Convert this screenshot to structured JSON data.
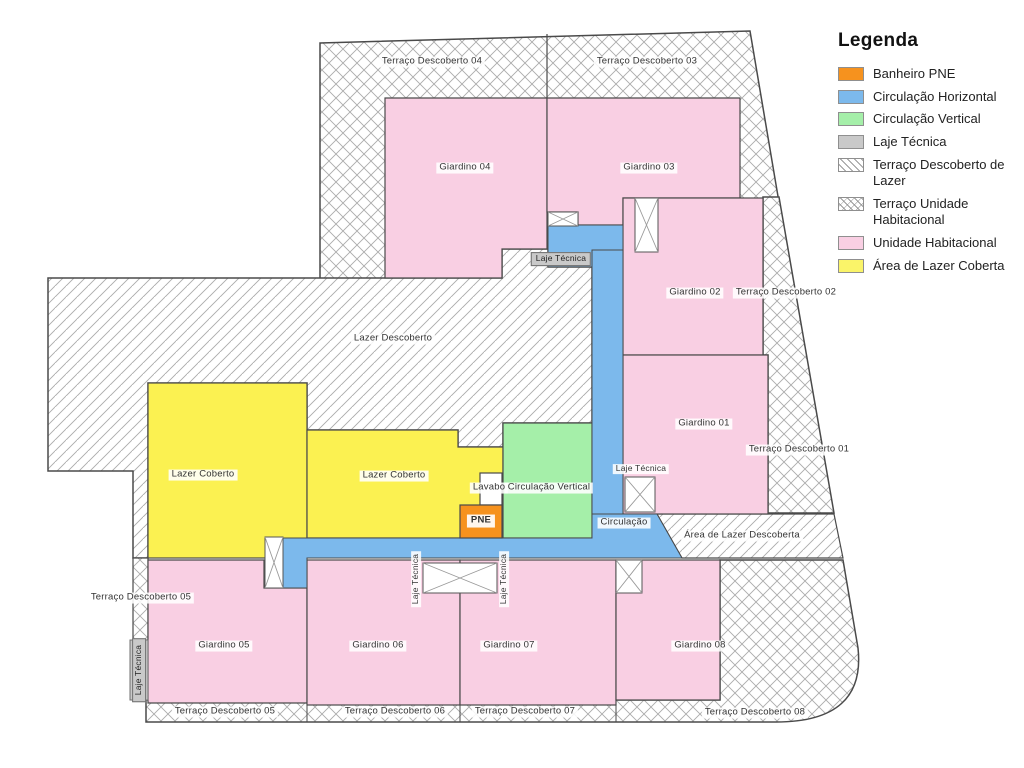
{
  "legend": {
    "title": "Legenda",
    "items": [
      {
        "label": "Banheiro PNE",
        "color": "#F6921E",
        "pattern": "solid"
      },
      {
        "label": "Circulação Horizontal",
        "color": "#7CB9EC",
        "pattern": "solid"
      },
      {
        "label": "Circulação Vertical",
        "color": "#A5EFA9",
        "pattern": "solid"
      },
      {
        "label": "Laje Técnica",
        "color": "#C9C9C9",
        "pattern": "solid"
      },
      {
        "label": "Terraço Descoberto de Lazer",
        "color": "#FFFFFF",
        "pattern": "diagonal"
      },
      {
        "label": "Terraço Unidade Habitacional",
        "color": "#FFFFFF",
        "pattern": "cross"
      },
      {
        "label": "Unidade Habitacional",
        "color": "#F9CFE3",
        "pattern": "solid"
      },
      {
        "label": "Área de Lazer Coberta",
        "color": "#FAF469",
        "pattern": "solid"
      }
    ]
  },
  "plan": {
    "labels": {
      "terraco_descoberto_01": "Terraço Descoberto 01",
      "terraco_descoberto_02": "Terraço Descoberto 02",
      "terraco_descoberto_03": "Terraço Descoberto 03",
      "terraco_descoberto_04": "Terraço Descoberto 04",
      "terraco_descoberto_05": "Terraço Descoberto 05",
      "terraco_descoberto_06": "Terraço Descoberto 06",
      "terraco_descoberto_07": "Terraço Descoberto 07",
      "terraco_descoberto_08": "Terraço Descoberto 08",
      "giardino_01": "Giardino 01",
      "giardino_02": "Giardino 02",
      "giardino_03": "Giardino 03",
      "giardino_04": "Giardino 04",
      "giardino_05": "Giardino 05",
      "giardino_06": "Giardino 06",
      "giardino_07": "Giardino 07",
      "giardino_08": "Giardino 08",
      "lazer_descoberto": "Lazer Descoberto",
      "lazer_coberto": "Lazer Coberto",
      "area_de_lazer_descoberta": "Área de Lazer Descoberta",
      "circulacao": "Circulação",
      "circulacao_vertical": "Circulação Vertical",
      "lavabo": "Lavabo",
      "laje_tecnica": "Laje Técnica",
      "pne": "PNE"
    }
  }
}
